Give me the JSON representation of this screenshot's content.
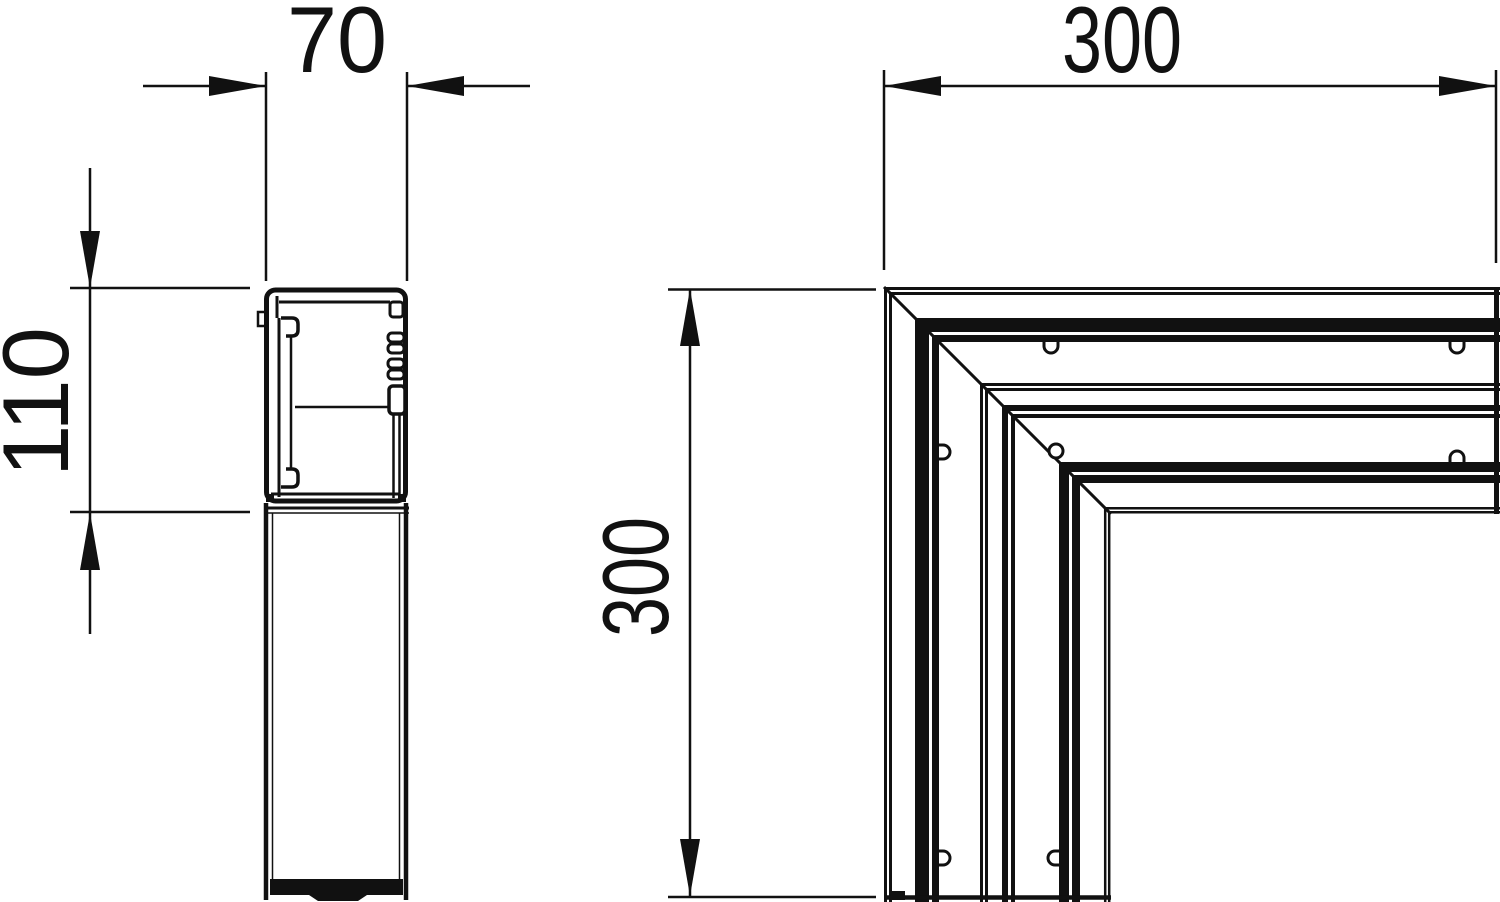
{
  "drawing": {
    "background": "#ffffff",
    "ink": "#111111",
    "views": {
      "profile_section": {
        "width_dim_label": "70",
        "height_dim_label": "110"
      },
      "flat_angle_plan": {
        "length_dim_label": "300",
        "height_dim_label": "300"
      }
    }
  }
}
